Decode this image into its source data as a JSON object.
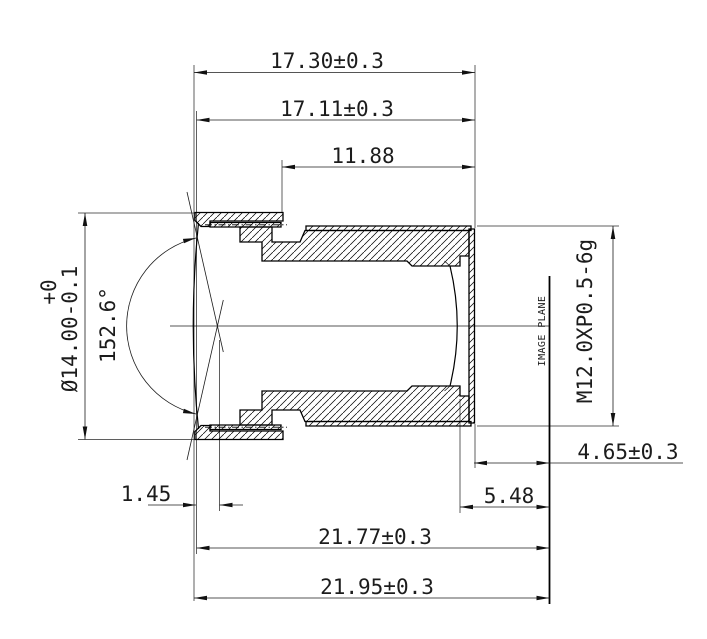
{
  "drawing": {
    "dims": {
      "total_length": "17.30±0.3",
      "body_length": "17.11±0.3",
      "thread_length": "11.88",
      "front_od": "Ø14.00-0.1",
      "front_od_tol_upper": "+0",
      "fov_angle": "152.6°",
      "thread_spec": "M12.0XP0.5-6g",
      "back_focal": "4.65±0.3",
      "mech_back_focal": "5.48",
      "front_vertex_offset": "1.45",
      "track_to_flange": "21.77±0.3",
      "total_track": "21.95±0.3",
      "image_plane_label": "IMAGE PLANE"
    },
    "colors": {
      "line": "#000000",
      "background": "#ffffff"
    }
  }
}
